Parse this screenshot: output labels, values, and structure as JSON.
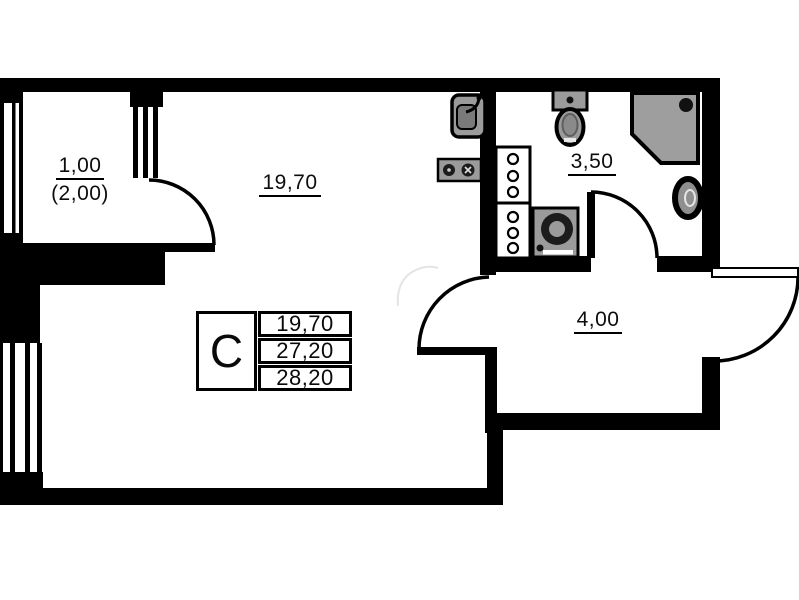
{
  "rooms": {
    "balcony": {
      "label": "1,00",
      "label_secondary": "(2,00)"
    },
    "living_room": {
      "label": "19,70"
    },
    "bathroom": {
      "label": "3,50"
    },
    "hallway": {
      "label": "4,00"
    }
  },
  "stamp": {
    "letter": "C",
    "row1": "19,70",
    "row2": "27,20",
    "row3": "28,20"
  },
  "fixtures": [
    "kitchen-sink",
    "cooktop",
    "ventilation-shaft",
    "ventilation-shaft",
    "toilet",
    "washing-machine",
    "shower",
    "washbasin"
  ],
  "colors": {
    "wall": "#000000",
    "fixture_gray": "#9b9b9b",
    "fixture_dark": "#1c1c1c",
    "background": "#ffffff"
  }
}
